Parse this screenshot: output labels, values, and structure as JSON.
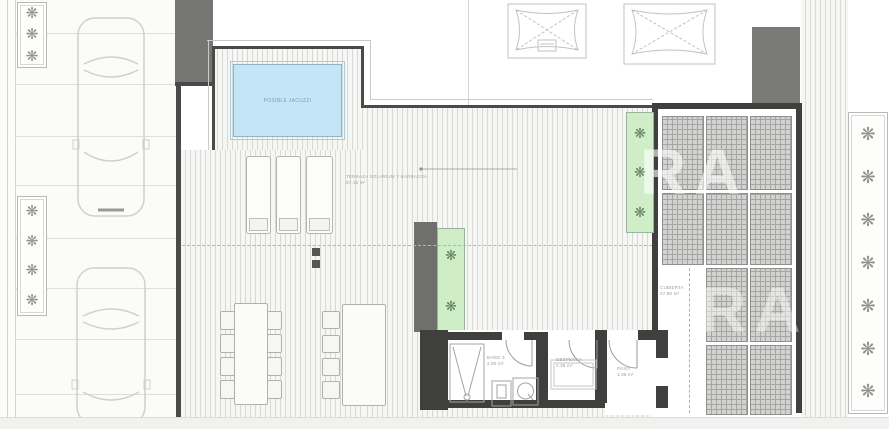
{
  "labels": {
    "jacuzzi": "POSIBLE JACUZZI",
    "terrace": {
      "name": "TERRAZA SOLARIUM Y BARBACOA",
      "area": "87.15 m²"
    },
    "cubierta": {
      "name": "CUBIERTA",
      "area": "27.80 m²"
    },
    "bano3": {
      "name": "BAÑO 3",
      "area": "2.85 m²"
    },
    "despensa": {
      "name": "DESPENSA",
      "area": "2.35 m²"
    },
    "paso": {
      "name": "PASO",
      "area": "3.36 m²"
    }
  },
  "watermark": {
    "row1": "RA",
    "row2": "RA"
  },
  "icons": {
    "plant": "❋"
  },
  "colors": {
    "wall": "#3f3f3d",
    "pier": "#6f6f6d",
    "deck_line": "#d8d8d6",
    "jacuzzi_fill": "#c3e5f5",
    "planter_green": "#cfeec8",
    "glass_grid": "#d2d2d0",
    "paper": "#ffffff",
    "bottom_strip": "#f2f1ef"
  }
}
